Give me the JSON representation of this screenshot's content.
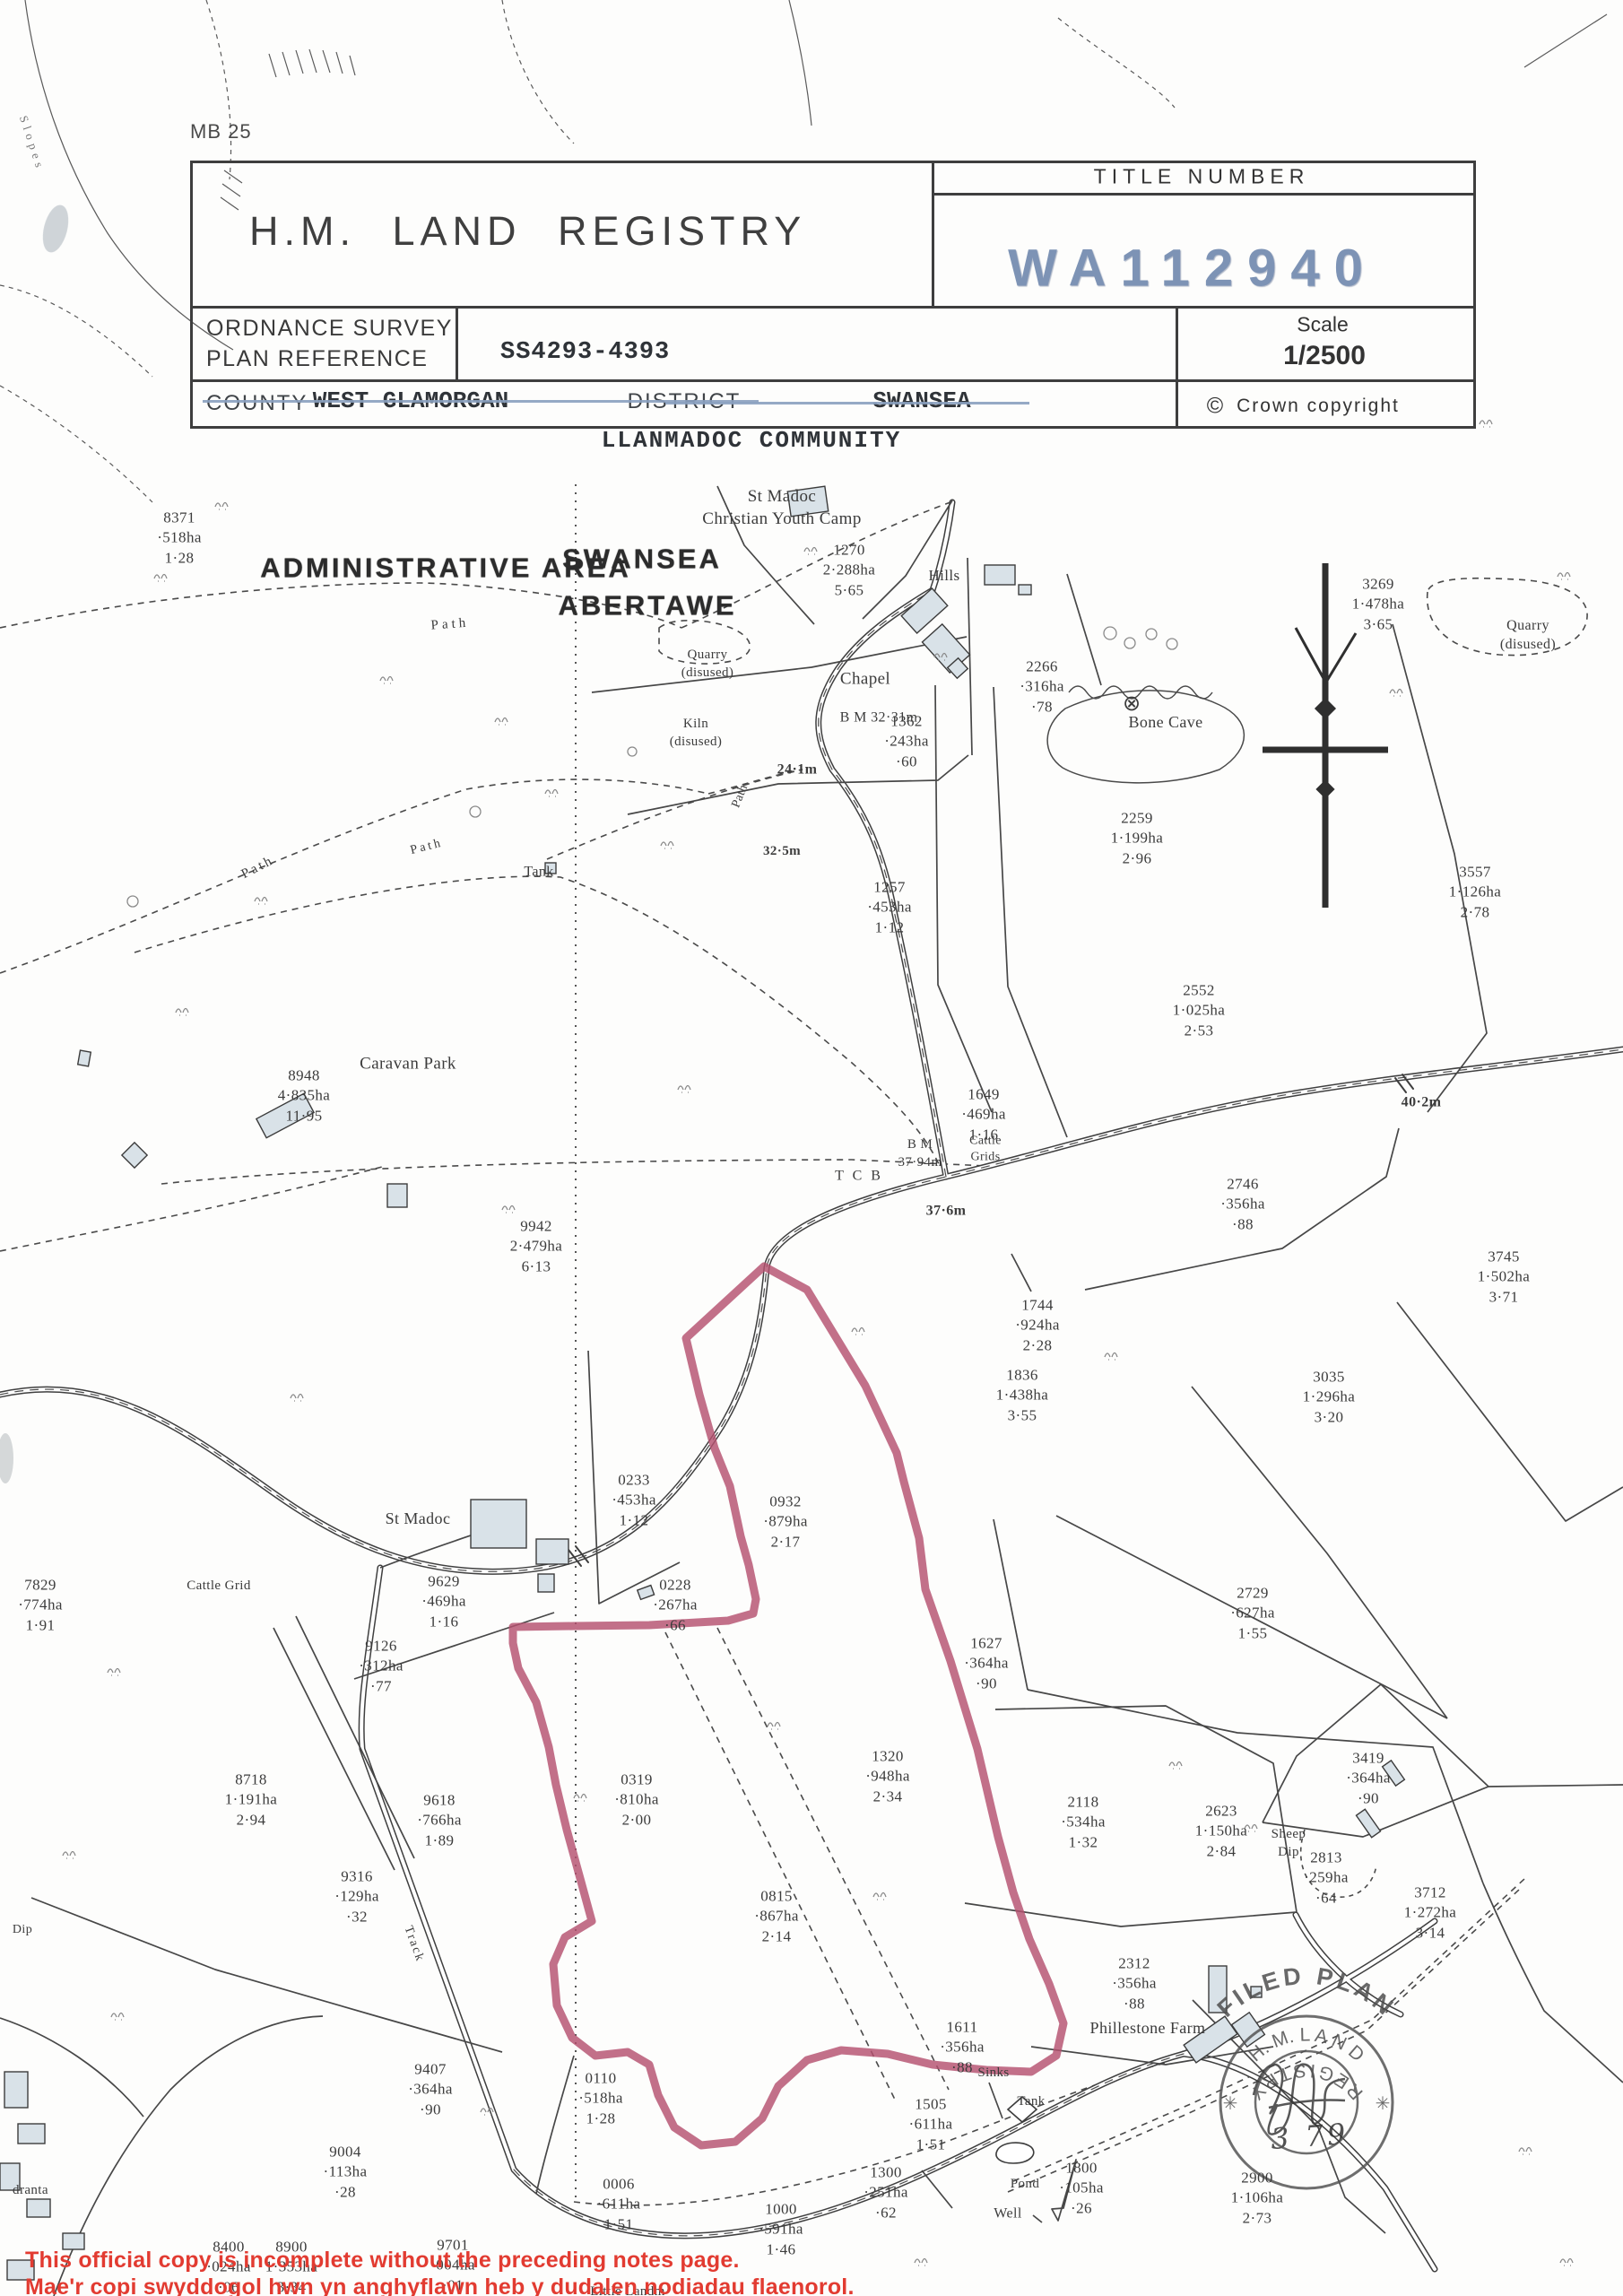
{
  "header": {
    "sheet_ref": "MB 25",
    "agency": "H.M.  LAND  REGISTRY",
    "title_number_label": "TITLE  NUMBER",
    "title_number": "WA112940",
    "os_ref_label": "ORDNANCE  SURVEY\nPLAN  REFERENCE",
    "os_ref_value": "SS4293-4393",
    "scale_label": "Scale",
    "scale_value": "1/2500",
    "copyright_text": "Crown  copyright",
    "county_label": "COUNTY",
    "county_value": "WEST GLAMORGAN",
    "district_label": "DISTRICT",
    "district_value": "SWANSEA",
    "community": "LLANMADOC COMMUNITY"
  },
  "icons": {
    "copyright": "©",
    "star": "✳",
    "bone_cave_marker": "⊗"
  },
  "map": {
    "parcels": [
      {
        "label": "8371\n·518ha\n1·28"
      },
      {
        "label": "1270\n2·288ha\n5·65"
      },
      {
        "label": "3269\n1·478ha\n3·65"
      },
      {
        "label": "2266\n·316ha\n·78"
      },
      {
        "label": "1362\n·243ha\n·60"
      },
      {
        "label": "2259\n1·199ha\n2·96"
      },
      {
        "label": "3557\n1·126ha\n2·78"
      },
      {
        "label": "1257\n·453ha\n1·12"
      },
      {
        "label": "2552\n1·025ha\n2·53"
      },
      {
        "label": "1649\n·469ha\n1·16"
      },
      {
        "label": "8948\n4·835ha\n11·95"
      },
      {
        "label": "2746\n·356ha\n·88"
      },
      {
        "label": "3745\n1·502ha\n3·71"
      },
      {
        "label": "9942\n2·479ha\n6·13"
      },
      {
        "label": "1744\n·924ha\n2·28"
      },
      {
        "label": "1836\n1·438ha\n3·55"
      },
      {
        "label": "3035\n1·296ha\n3·20"
      },
      {
        "label": "0233\n·453ha\n1·12"
      },
      {
        "label": "0932\n·879ha\n2·17"
      },
      {
        "label": "2729\n·627ha\n1·55"
      },
      {
        "label": "9629\n·469ha\n1·16"
      },
      {
        "label": "0228\n·267ha\n·66"
      },
      {
        "label": "1627\n·364ha\n·90"
      },
      {
        "label": "9126\n·312ha\n·77"
      },
      {
        "label": "2623\n1·150ha\n2·84"
      },
      {
        "label": "7829\n·774ha\n1·91"
      },
      {
        "label": "8718\n1·191ha\n2·94"
      },
      {
        "label": "9618\n·766ha\n1·89"
      },
      {
        "label": "0319\n·810ha\n2·00"
      },
      {
        "label": "9316\n·129ha\n·32"
      },
      {
        "label": "1320\n·948ha\n2·34"
      },
      {
        "label": "2118\n·534ha\n1·32"
      },
      {
        "label": "0815\n·867ha\n2·14"
      },
      {
        "label": "3419\n·364ha\n·90"
      },
      {
        "label": "2312\n·356ha\n·88"
      },
      {
        "label": "1611\n·356ha\n·88"
      },
      {
        "label": "2813\n·259ha\n·64"
      },
      {
        "label": "3712\n1·272ha\n3·14"
      },
      {
        "label": "0110\n·518ha\n1·28"
      },
      {
        "label": "9407\n·364ha\n·90"
      },
      {
        "label": "9004\n·113ha\n·28"
      },
      {
        "label": "0006\n·611ha\n1·51"
      },
      {
        "label": "1505\n·611ha\n1·51"
      },
      {
        "label": "1300\n·251ha\n·62"
      },
      {
        "label": "1000\n·591ha\n1·46"
      },
      {
        "label": "1800\n·105ha\n·26"
      },
      {
        "label": "2900\n1·106ha\n2·73"
      },
      {
        "label": "8400\n·024ha\n·06"
      },
      {
        "label": "8900\n1·353ha\n3·34"
      },
      {
        "label": "9701\n·004ha\n·01"
      }
    ],
    "features": [
      {
        "label": "Slopes"
      },
      {
        "label": "ADMINISTRATIVE AREA"
      },
      {
        "label": "SWANSEA"
      },
      {
        "label": "ABERTAWE"
      },
      {
        "label": "St Madoc\nChristian Youth Camp"
      },
      {
        "label": "Hills"
      },
      {
        "label": "Chapel"
      },
      {
        "label": "B M 32·31m"
      },
      {
        "label": "Quarry\n(disused)"
      },
      {
        "label": "Quarry\n(disused)"
      },
      {
        "label": "Path"
      },
      {
        "label": "Path"
      },
      {
        "label": "Path"
      },
      {
        "label": "Path"
      },
      {
        "label": "Kiln\n(disused)"
      },
      {
        "label": "24·1m"
      },
      {
        "label": "Bone Cave"
      },
      {
        "label": "Tank"
      },
      {
        "label": "Caravan Park"
      },
      {
        "label": "32·5m"
      },
      {
        "label": "T C B"
      },
      {
        "label": "B M\n37·94m"
      },
      {
        "label": "37·6m"
      },
      {
        "label": "Cattle\nGrids"
      },
      {
        "label": "40·2m"
      },
      {
        "label": "Cattle Grid"
      },
      {
        "label": "St Madoc"
      },
      {
        "label": "Track"
      },
      {
        "label": "Sheep\nDip"
      },
      {
        "label": "Phillestone Farm"
      },
      {
        "label": "Sinks"
      },
      {
        "label": "Tank"
      },
      {
        "label": "Pond"
      },
      {
        "label": "Well"
      },
      {
        "label": "Dip"
      },
      {
        "label": "dranta"
      },
      {
        "label": "Little Landm"
      }
    ]
  },
  "stamps": {
    "filed_plan": "FILED  PLAN",
    "registry_top": "H. M.  L A N D",
    "registry_bottom": "R E G I S T R Y",
    "date": "3  79"
  },
  "footer": {
    "notice_en": "This official copy is incomplete without the preceding notes page.",
    "notice_cy": "Mae'r copi swyddogol hwn yn anghyflawn heb y dudalen nodiadau flaenorol."
  },
  "colors": {
    "boundary_red": "#b5506f",
    "stamp_blue": "#7d93b5",
    "notice_red": "#e23b31",
    "ink": "#3c3c3c"
  }
}
